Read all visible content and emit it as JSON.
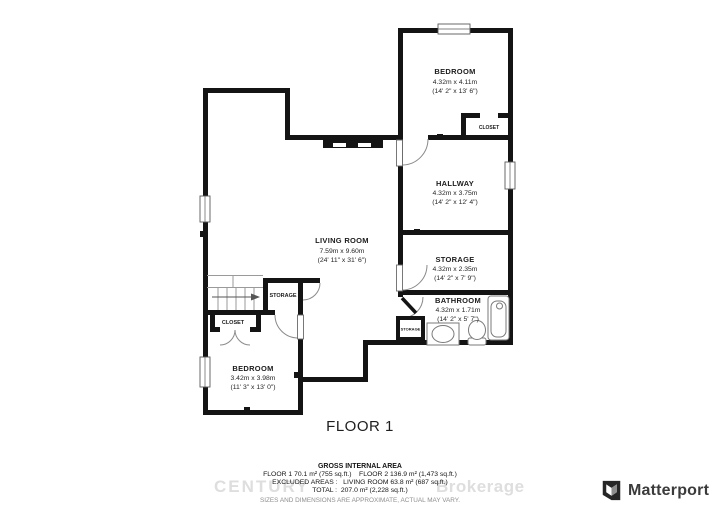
{
  "plan": {
    "floor_label": "FLOOR 1",
    "rooms": {
      "bedroom_top": {
        "name": "BEDROOM",
        "metric": "4.32m x 4.11m",
        "imperial": "(14' 2\" x 13' 6\")"
      },
      "hallway": {
        "name": "HALLWAY",
        "metric": "4.32m x 3.75m",
        "imperial": "(14' 2\" x 12' 4\")"
      },
      "storage": {
        "name": "STORAGE",
        "metric": "4.32m x 2.35m",
        "imperial": "(14' 2\" x 7' 9\")"
      },
      "bathroom": {
        "name": "BATHROOM",
        "metric": "4.32m x 1.71m",
        "imperial": "(14' 2\" x 5' 7\")"
      },
      "living_room": {
        "name": "LIVING ROOM",
        "metric": "7.59m x 9.60m",
        "imperial": "(24' 11\" x 31' 6\")"
      },
      "bedroom_bottom": {
        "name": "BEDROOM",
        "metric": "3.42m x 3.98m",
        "imperial": "(11' 3\" x 13' 0\")"
      },
      "closet_top": {
        "name": "CLOSET"
      },
      "closet_bottom": {
        "name": "CLOSET"
      },
      "storage_small": {
        "name": "STORAGE"
      },
      "storage_tiny": {
        "name": "STORAGE"
      }
    }
  },
  "footer": {
    "gross_title": "GROSS INTERNAL AREA",
    "line1": "FLOOR 1 70.1 m² (755 sq.ft.)    FLOOR 2 136.9 m² (1,473 sq.ft.)",
    "line2": "EXCLUDED AREAS :   LIVING ROOM 63.8 m² (687 sq.ft.)",
    "line3": "TOTAL :  207.0 m² (2,228 sq.ft.)",
    "disclaimer": "SIZES AND DIMENSIONS ARE APPROXIMATE, ACTUAL MAY VARY."
  },
  "watermark": {
    "left": "CENTURY",
    "right": "Brokerage"
  },
  "branding": {
    "logo_text": "Matterport"
  },
  "colors": {
    "wall": "#141414",
    "fixture_line": "#7a7a7a",
    "watermark": "#dedede",
    "disclaimer_text": "#8f8f8f",
    "logo_text": "#3b3b3b"
  }
}
